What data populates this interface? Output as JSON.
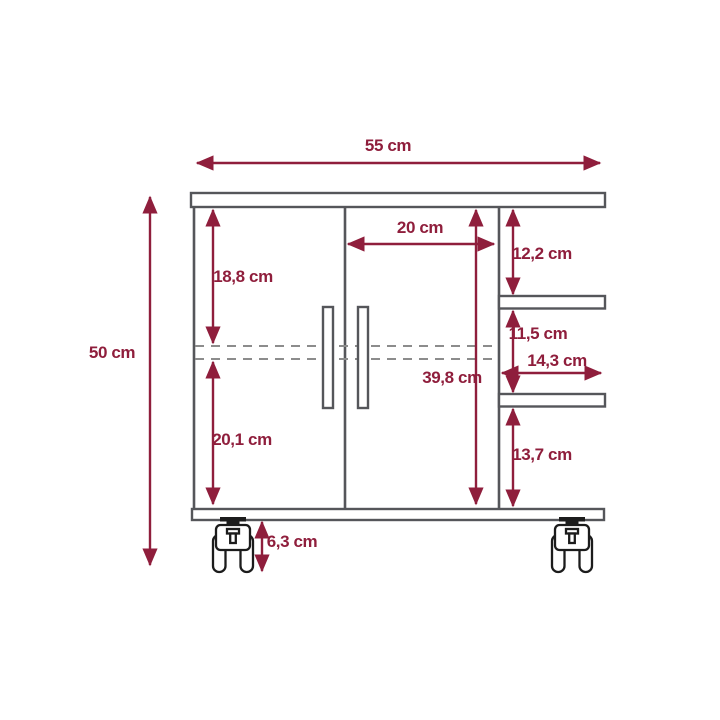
{
  "diagram": {
    "subject": "cabinet-with-casters-dimension-drawing",
    "unit": "cm",
    "colors": {
      "dimension_accent": "#8F1E3C",
      "structure_gray": "#55565A",
      "dashed_gray": "#8C8C8C",
      "caster_black": "#1C1C1C",
      "background": "#FFFFFF"
    },
    "dimensions": {
      "total_width": "55 cm",
      "total_height": "50 cm",
      "door_opening_width": "20 cm",
      "upper_door_section": "18,8 cm",
      "lower_door_section": "20,1 cm",
      "upper_shelf_space": "12,2 cm",
      "middle_shelf_space": "11,5 cm",
      "shelf_width": "14,3 cm",
      "side_column_height": "39,8 cm",
      "lower_shelf_space": "13,7 cm",
      "caster_height": "6,3 cm"
    }
  }
}
